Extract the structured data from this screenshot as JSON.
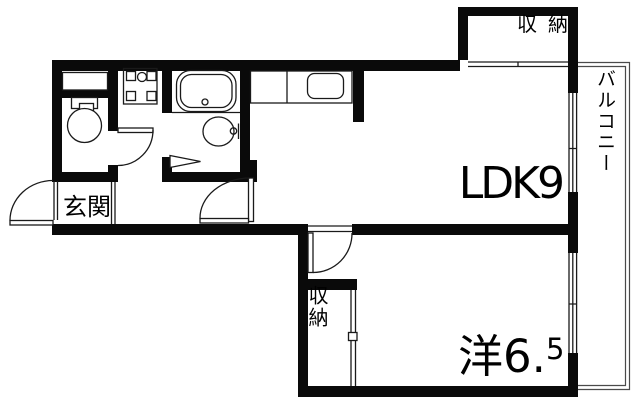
{
  "page": {
    "type": "apartment-floor-plan",
    "background": "#ffffff",
    "wall_color": "#0a0a0a",
    "line_color": "#1a1a1a",
    "balcony_line_color": "#4a4a4a"
  },
  "rooms": {
    "ldk": {
      "label": "LDK9"
    },
    "western_room": {
      "label_main": "洋6.",
      "label_sup": "5"
    },
    "entrance": {
      "label": "玄関"
    },
    "balcony": {
      "label": "バルコニー"
    },
    "closet_top": {
      "label": "収納"
    },
    "closet_bottom": {
      "label": "収納"
    }
  },
  "fixtures": [
    "bathtub",
    "washbasin",
    "toilet",
    "kitchen-sink",
    "washing-machine-pan",
    "hinged-doors",
    "sliding-doors",
    "windows"
  ]
}
